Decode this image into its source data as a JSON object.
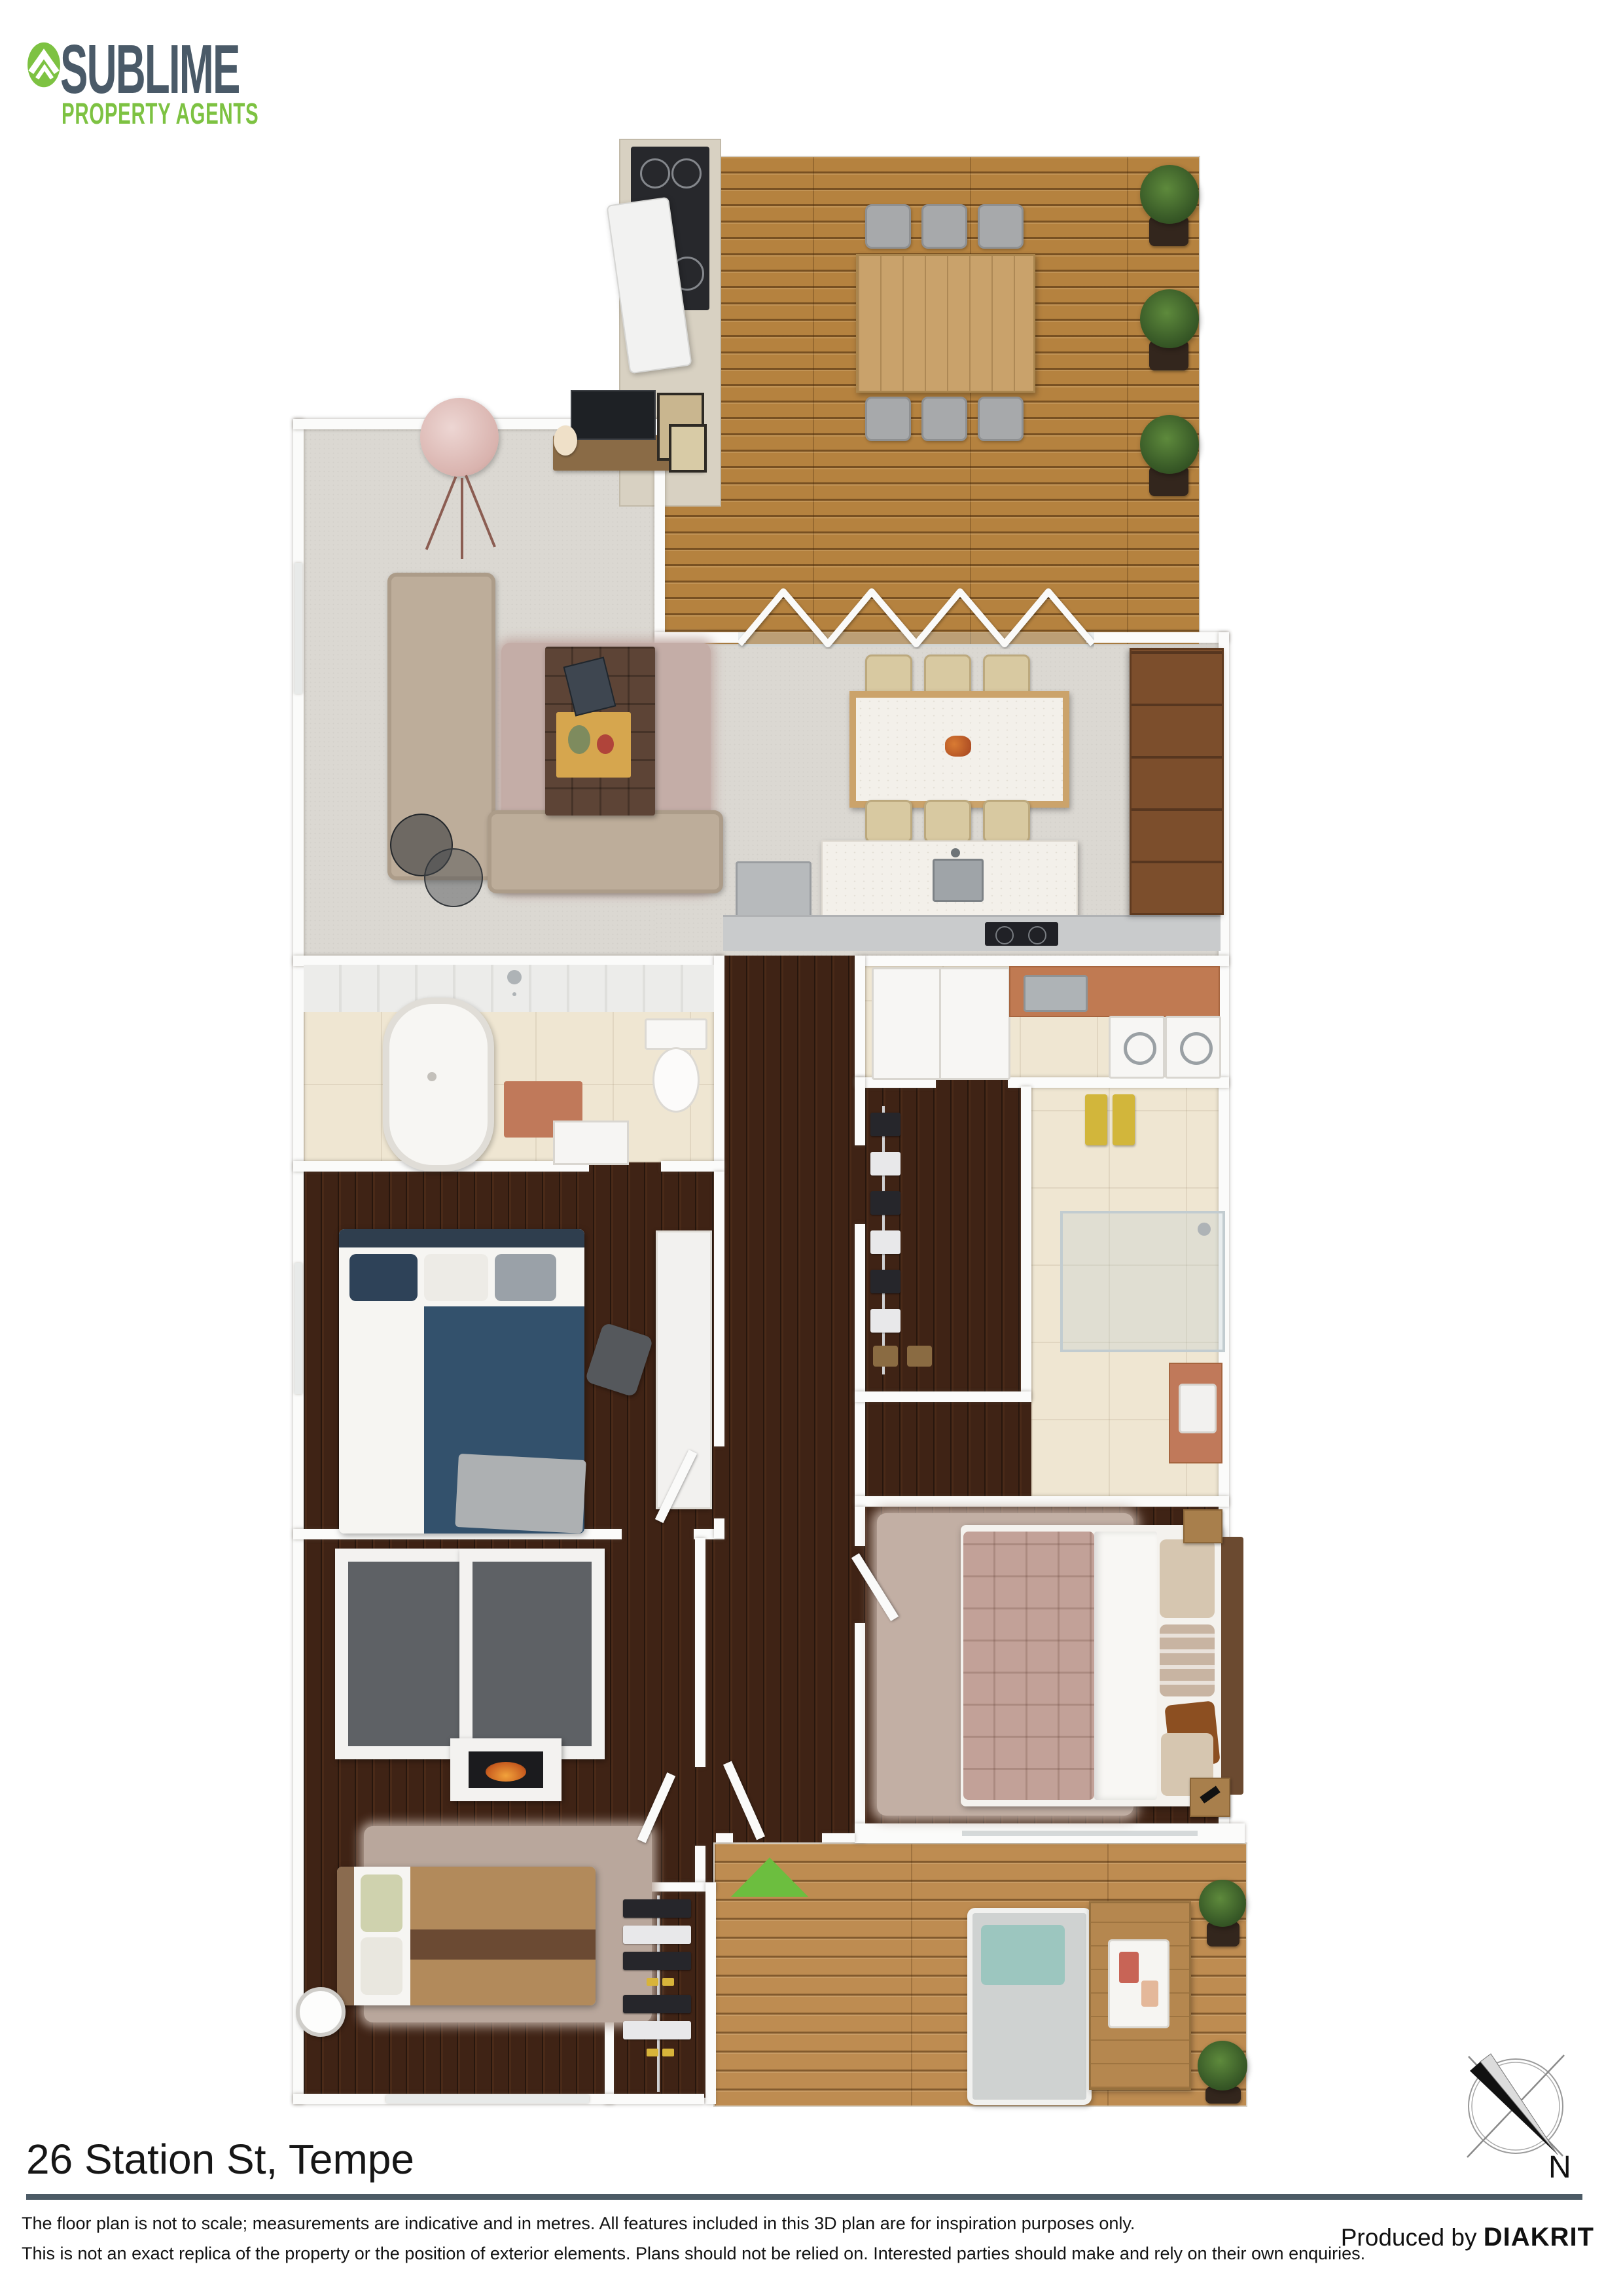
{
  "brand": {
    "name": "SUBLIME",
    "tagline": "PROPERTY AGENTS",
    "green": "#7DC242",
    "slate": "#4A5A68"
  },
  "plan": {
    "entry_marker_color": "#6CBE3F",
    "deck_wood_color": "#B5823F",
    "interior_wood_color": "#3F2315",
    "carpet_color": "#DBD8D2"
  },
  "compass": {
    "label": "N"
  },
  "footer": {
    "address": "26 Station St, Tempe",
    "divider_color": "#4C5B66",
    "disclaimer_line1": "The floor plan is not to scale; measurements are indicative and in metres. All features included in this 3D plan are for inspiration purposes only.",
    "disclaimer_line2": "This is not an exact replica of the property or the position of exterior elements. Plans should not be relied on. Interested parties should make and rely on their own enquiries.",
    "produced_by": "Produced by",
    "producer": "DIAKRIT"
  }
}
